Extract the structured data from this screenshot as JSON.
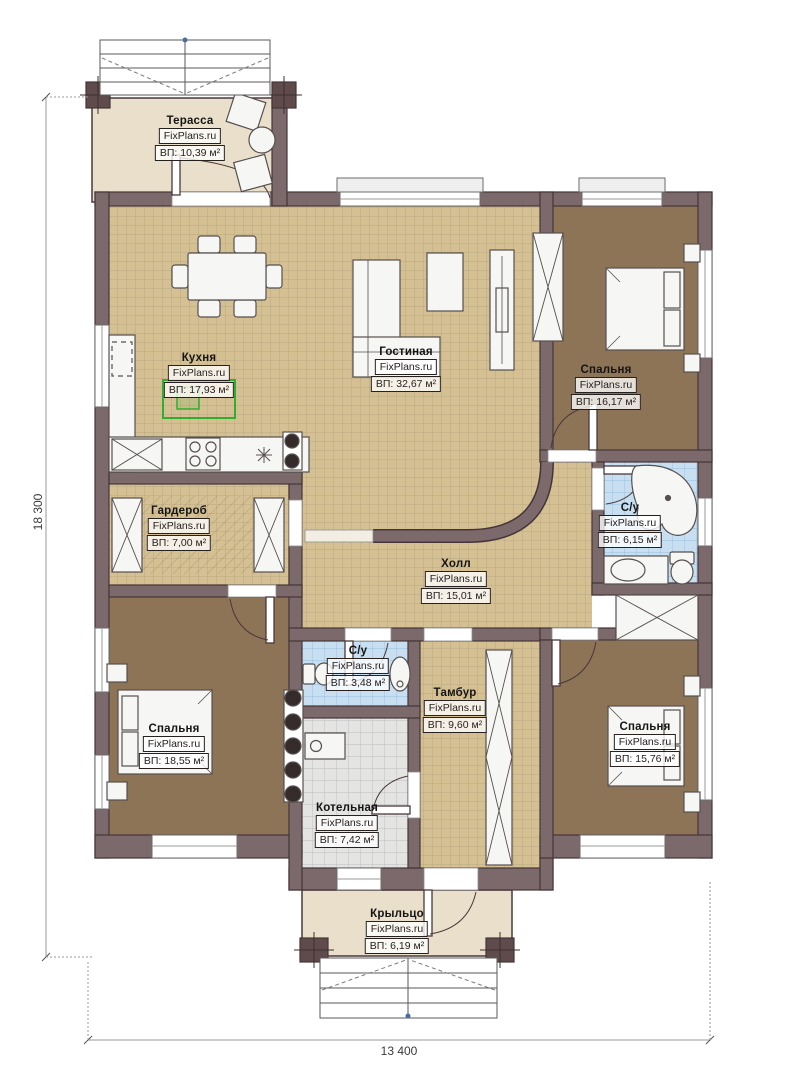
{
  "title": "План одноэтажного дома",
  "watermark": "FixPlans.ru",
  "dimensions": {
    "height_label": "18 300",
    "width_label": "13 400"
  },
  "rooms": [
    {
      "id": "terrace",
      "name": "Терасса",
      "area": "ВП: 10,39 м²"
    },
    {
      "id": "kitchen",
      "name": "Кухня",
      "area": "ВП: 17,93 м²"
    },
    {
      "id": "living",
      "name": "Гостиная",
      "area": "ВП: 32,67 м²"
    },
    {
      "id": "bedroom-tr",
      "name": "Спальня",
      "area": "ВП: 16,17 м²"
    },
    {
      "id": "bath-tr",
      "name": "С/у",
      "area": "ВП: 6,15 м²"
    },
    {
      "id": "wardrobe",
      "name": "Гардероб",
      "area": "ВП: 7,00 м²"
    },
    {
      "id": "hall",
      "name": "Холл",
      "area": "ВП: 15,01 м²"
    },
    {
      "id": "bath-small",
      "name": "С/у",
      "area": "ВП: 3,48 м²"
    },
    {
      "id": "tambur",
      "name": "Тамбур",
      "area": "ВП: 9,60 м²"
    },
    {
      "id": "bedroom-bl",
      "name": "Спальня",
      "area": "ВП: 18,55 м²"
    },
    {
      "id": "boiler",
      "name": "Котельная",
      "area": "ВП: 7,42 м²"
    },
    {
      "id": "bedroom-br",
      "name": "Спальня",
      "area": "ВП: 15,76 м²"
    },
    {
      "id": "porch",
      "name": "Крыльцо",
      "area": "ВП: 6,19 м²"
    }
  ],
  "colors": {
    "wall": "#7c696b",
    "wall_edge": "#453538",
    "floor_tile_tan": "#d5c094",
    "floor_bedroom": "#8d7457",
    "floor_bath": "#c8dff2",
    "floor_boiler": "#e4e4e3",
    "floor_terrace": "#e9dfca",
    "selection_green": "#2fae2f"
  }
}
